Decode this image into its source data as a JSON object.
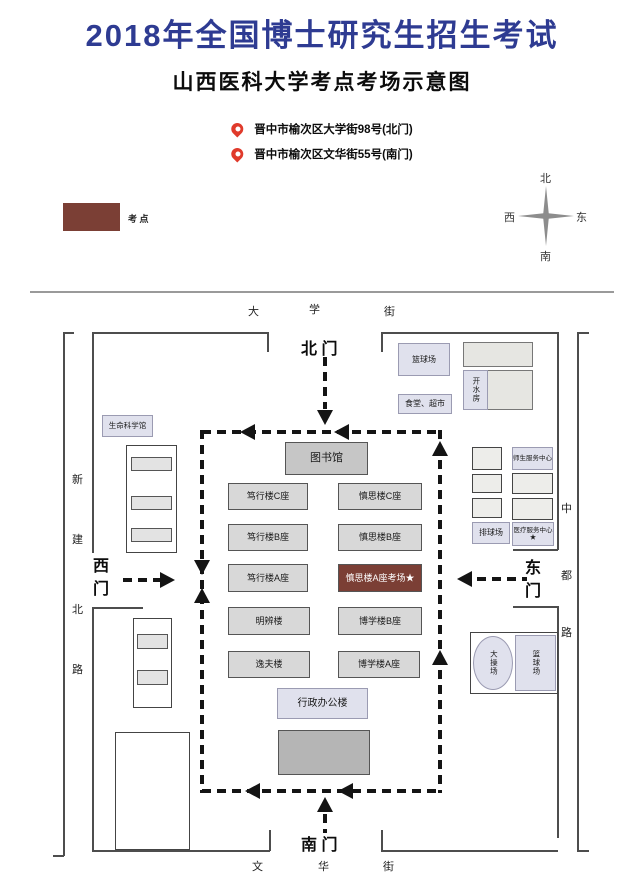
{
  "header": {
    "title": "2018年全国博士研究生招生考试",
    "subtitle": "山西医科大学考点考场示意图",
    "address_north": "晋中市榆次区大学街98号(北门)",
    "address_south": "晋中市榆次区文华街55号(南门)"
  },
  "legend": {
    "label": "考 点",
    "swatch_color": "#7b3f35"
  },
  "compass": {
    "north": "北",
    "south": "南",
    "west": "西",
    "east": "东"
  },
  "streets": {
    "top": [
      "大",
      "学",
      "街"
    ],
    "bottom": [
      "文",
      "华",
      "街"
    ],
    "left_road": [
      "新",
      "建",
      "北",
      "路"
    ],
    "right_road": [
      "中",
      "都",
      "路"
    ]
  },
  "gates": {
    "north": "北 门",
    "south": "南 门",
    "west": "西门",
    "east": "东门"
  },
  "buildings": {
    "library": "图书馆",
    "left_column": [
      "笃行楼C座",
      "笃行楼B座",
      "笃行楼A座",
      "明辨楼",
      "逸夫楼"
    ],
    "right_column": [
      "慎思楼C座",
      "慎思楼B座",
      "慎思楼A座考场★",
      "博学楼B座",
      "博学楼A座"
    ],
    "admin": "行政办公楼"
  },
  "facilities": {
    "life_science": "生命科学馆",
    "basketball_north": "篮球场",
    "canteen": "食堂、超市",
    "hot_water": "开水房",
    "service_center": "师生服务中心",
    "volleyball": "排球场",
    "medical": "医疗服务中心★",
    "playground": "大操场",
    "basketball_east": "篮球场"
  },
  "colors": {
    "title_blue": "#2e3b92",
    "exam_site_red": "#7b3f35",
    "pin_red": "#e03a2b"
  }
}
